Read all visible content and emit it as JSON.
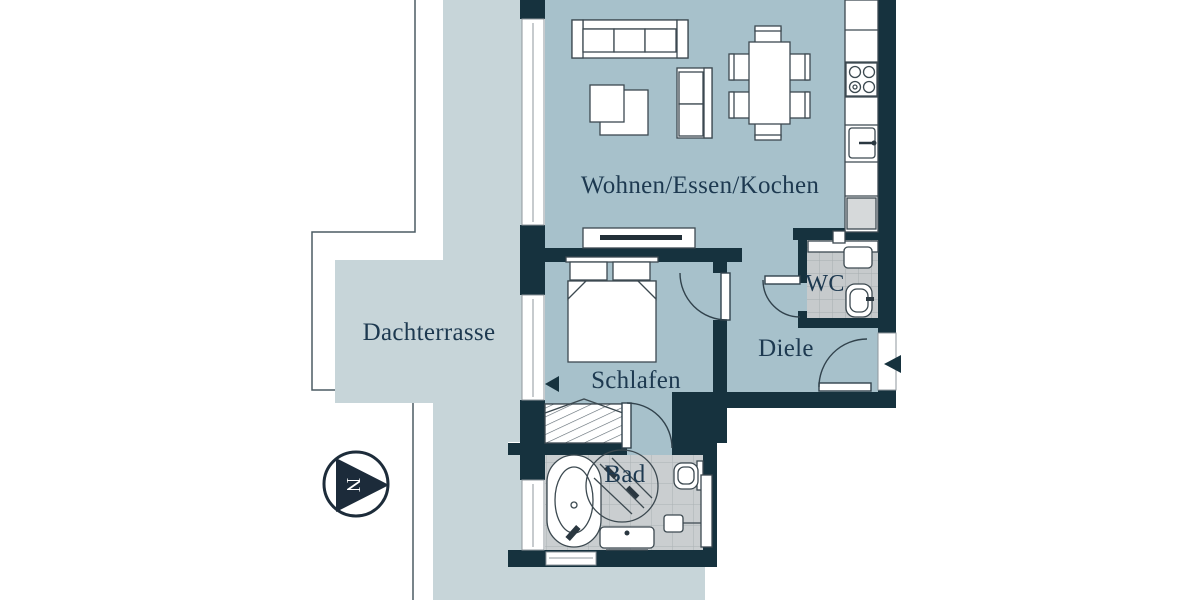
{
  "floorplan": {
    "rooms": [
      {
        "name": "living-dining-kitchen",
        "label": "Wohnen/Essen/Kochen"
      },
      {
        "name": "roof-terrace",
        "label": "Dachterrasse"
      },
      {
        "name": "bedroom",
        "label": "Schlafen"
      },
      {
        "name": "hallway",
        "label": "Diele"
      },
      {
        "name": "wc",
        "label": "WC"
      },
      {
        "name": "bathroom",
        "label": "Bad"
      }
    ],
    "compass": {
      "label": "N",
      "direction": "right"
    },
    "colors": {
      "wall": "#16323e",
      "room_fill": "#a7c1cb",
      "terrace_fill": "#c7d5d9",
      "tile_fill": "#caced0",
      "tile_grid": "#abb1b4",
      "label_text": "#1d3950",
      "furniture_outline": "#3c4950",
      "background": "#ffffff"
    },
    "icons": [
      "north-arrow-icon",
      "entrance-arrow-icon",
      "terrace-door-arrow-icon",
      "sofa-icon",
      "armchair-icon",
      "loveseat-icon",
      "dining-table-icon",
      "kitchen-counter",
      "cooktop-icon",
      "kitchen-sink-icon",
      "sideboard-tv-icon",
      "bed-icon",
      "wardrobe-icon",
      "bathtub-icon",
      "shower-icon",
      "vanity-icon",
      "toilet-icon",
      "wc-sink-icon",
      "door-arc",
      "window"
    ]
  }
}
